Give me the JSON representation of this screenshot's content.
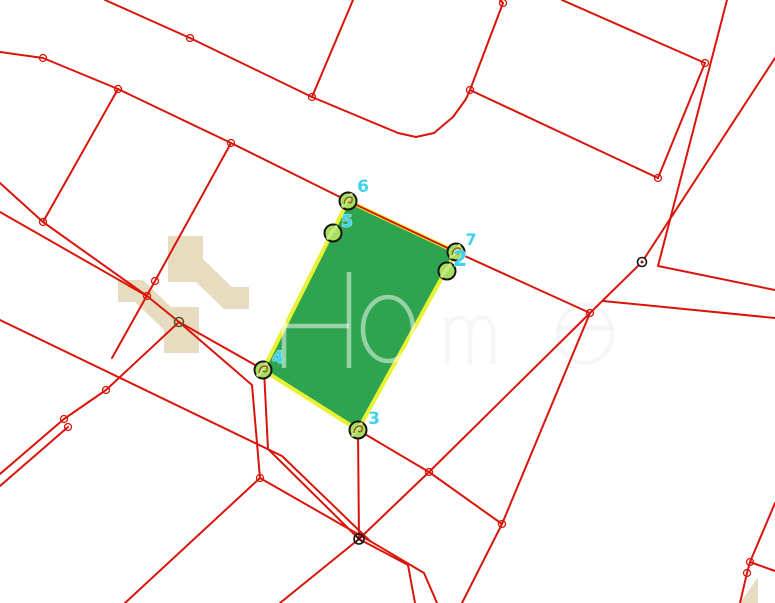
{
  "canvas": {
    "width": 775,
    "height": 603,
    "background": "#ffffff"
  },
  "map": {
    "colors": {
      "line_red": "#d9150b",
      "parcel_fill": "#2fa44e",
      "parcel_stroke": "#e9f232",
      "marker_fill": "#a8e05e",
      "marker_fill_light": "#c3ec86",
      "marker_stroke": "#151515",
      "label_cyan": "#3ed2ee",
      "squiggle_brown": "#96591f",
      "logo_beige": "#e6dabc",
      "watermark_gray": "#cccccc",
      "dark_node": "#55562b",
      "black_node": "#111111"
    },
    "parcel": {
      "points": [
        [
          348,
          201
        ],
        [
          456,
          252
        ],
        [
          358,
          430
        ],
        [
          263,
          370
        ]
      ],
      "stroke_width": 4
    },
    "roads": {
      "stroke_width": 2,
      "polylines": [
        {
          "name": "road-top-diagonal",
          "points": [
            [
              105,
              0
            ],
            [
              190,
              38
            ],
            [
              312,
              97
            ],
            [
              398,
              133
            ],
            [
              416,
              137
            ],
            [
              434,
              133
            ],
            [
              453,
              117
            ],
            [
              466,
              99
            ],
            [
              470,
              90
            ]
          ]
        },
        {
          "name": "parcel-edge-ne",
          "points": [
            [
              500,
              0
            ],
            [
              503,
              3
            ],
            [
              470,
              90
            ]
          ]
        },
        {
          "name": "parcel-edge-east",
          "points": [
            [
              470,
              90
            ],
            [
              658,
              178
            ]
          ]
        },
        {
          "name": "parcel-edge-up",
          "points": [
            [
              658,
              178
            ],
            [
              705,
              63
            ]
          ]
        },
        {
          "name": "parcel-edge-top",
          "points": [
            [
              705,
              63
            ],
            [
              562,
              0
            ]
          ]
        },
        {
          "name": "spur-top-vertical",
          "points": [
            [
              353,
              0
            ],
            [
              312,
              97
            ]
          ]
        },
        {
          "name": "road-main-diagonal",
          "points": [
            [
              0,
              52
            ],
            [
              43,
              58
            ],
            [
              118,
              89
            ],
            [
              231,
              143
            ],
            [
              348,
              201
            ],
            [
              456,
              252
            ],
            [
              590,
              313
            ]
          ]
        },
        {
          "name": "branch-left-vertical",
          "points": [
            [
              118,
              89
            ],
            [
              43,
              222
            ]
          ]
        },
        {
          "name": "branch-center-vertical",
          "points": [
            [
              231,
              143
            ],
            [
              155,
              281
            ],
            [
              112,
              358
            ]
          ]
        },
        {
          "name": "road-left-upper-1",
          "points": [
            [
              0,
              183
            ],
            [
              43,
              222
            ],
            [
              147,
              296
            ],
            [
              179,
              322
            ]
          ]
        },
        {
          "name": "road-left-upper-2",
          "points": [
            [
              0,
              212
            ],
            [
              147,
              296
            ]
          ]
        },
        {
          "name": "road-left-lower-1",
          "points": [
            [
              0,
              320
            ],
            [
              282,
              456
            ],
            [
              370,
              541
            ],
            [
              424,
              573
            ],
            [
              437,
              603
            ]
          ]
        },
        {
          "name": "road-left-lower-2",
          "points": [
            [
              0,
              474
            ],
            [
              64,
              419
            ],
            [
              106,
              390
            ],
            [
              179,
              322
            ]
          ]
        },
        {
          "name": "road-left-lower-3",
          "points": [
            [
              0,
              486
            ],
            [
              68,
              427
            ]
          ]
        },
        {
          "name": "road-v4-south",
          "points": [
            [
              179,
              322
            ],
            [
              264,
              370
            ],
            [
              268,
              449
            ],
            [
              359,
              539
            ],
            [
              408,
              565
            ],
            [
              415,
              603
            ]
          ]
        },
        {
          "name": "road-fan-south",
          "points": [
            [
              179,
              322
            ],
            [
              252,
              385
            ],
            [
              260,
              478
            ],
            [
              125,
              603
            ]
          ]
        },
        {
          "name": "road-fan-southeast",
          "points": [
            [
              260,
              478
            ],
            [
              370,
              541
            ]
          ]
        },
        {
          "name": "road-x-diagonal",
          "points": [
            [
              590,
              313
            ],
            [
              429,
              472
            ],
            [
              359,
              539
            ],
            [
              280,
              603
            ]
          ]
        },
        {
          "name": "road-tri-south",
          "points": [
            [
              590,
              313
            ],
            [
              502,
              524
            ],
            [
              462,
              603
            ]
          ]
        },
        {
          "name": "road-tri-base",
          "points": [
            [
              429,
              472
            ],
            [
              502,
              524
            ]
          ]
        },
        {
          "name": "road-v3-vertical",
          "points": [
            [
              358,
              432
            ],
            [
              359,
              539
            ]
          ]
        },
        {
          "name": "road-v3-link",
          "points": [
            [
              358,
              430
            ],
            [
              429,
              472
            ]
          ]
        },
        {
          "name": "road-ne-outer",
          "points": [
            [
              727,
              0
            ],
            [
              658,
              266
            ],
            [
              775,
              290
            ]
          ]
        },
        {
          "name": "road-ne-inner",
          "points": [
            [
              775,
              58
            ],
            [
              642,
              262
            ],
            [
              590,
              313
            ]
          ]
        },
        {
          "name": "road-east",
          "points": [
            [
              603,
              301
            ],
            [
              775,
              318
            ]
          ]
        },
        {
          "name": "road-se-corner",
          "points": [
            [
              775,
              503
            ],
            [
              750,
              562
            ],
            [
              747,
              573
            ],
            [
              740,
              603
            ]
          ]
        },
        {
          "name": "road-se-spur",
          "points": [
            [
              750,
              562
            ],
            [
              775,
              571
            ]
          ]
        }
      ]
    },
    "nodes": {
      "radius": 3.5,
      "points": [
        [
          43,
          58
        ],
        [
          118,
          89
        ],
        [
          231,
          143
        ],
        [
          190,
          38
        ],
        [
          312,
          97
        ],
        [
          503,
          3
        ],
        [
          470,
          90
        ],
        [
          658,
          178
        ],
        [
          705,
          63
        ],
        [
          43,
          222
        ],
        [
          147,
          296
        ],
        [
          155,
          281
        ],
        [
          106,
          390
        ],
        [
          64,
          419
        ],
        [
          68,
          427
        ],
        [
          260,
          478
        ],
        [
          429,
          472
        ],
        [
          502,
          524
        ],
        [
          590,
          313
        ],
        [
          750,
          562
        ],
        [
          747,
          573
        ]
      ]
    },
    "special_nodes": {
      "dark_ring": {
        "x": 179,
        "y": 322
      },
      "control_point": {
        "x": 642,
        "y": 262
      },
      "x_node": {
        "x": 359,
        "y": 539
      }
    },
    "markers": {
      "radius": 8.5,
      "items": [
        {
          "id": "6",
          "cx": 348,
          "cy": 201,
          "label": "6",
          "lx": 363,
          "ly": 192,
          "size": 17,
          "squiggle": true
        },
        {
          "id": "5",
          "cx": 333,
          "cy": 233,
          "label": "5",
          "lx": 347,
          "ly": 227,
          "size": 17,
          "squiggle": false
        },
        {
          "id": "7",
          "cx": 456,
          "cy": 252,
          "label": "7",
          "lx": 471,
          "ly": 245,
          "size": 16,
          "squiggle": true
        },
        {
          "id": "2",
          "cx": 447,
          "cy": 271,
          "label": "2",
          "lx": 460,
          "ly": 266,
          "size": 21,
          "squiggle": false
        },
        {
          "id": "4",
          "cx": 263,
          "cy": 370,
          "label": "4",
          "lx": 278,
          "ly": 363,
          "size": 17,
          "squiggle": true
        },
        {
          "id": "3",
          "cx": 358,
          "cy": 430,
          "label": "3",
          "lx": 374,
          "ly": 424,
          "size": 17,
          "squiggle": true
        }
      ]
    },
    "watermark": {
      "logo_pieces": [
        {
          "name": "logo-arrow-upper",
          "d": "M168,236 L203,236 L203,259 L232,287 L249,287 L249,309 L224,309 L196,282 L168,282 Z"
        },
        {
          "name": "logo-arrow-lower",
          "d": "M199,353 L164,353 L164,330 L135,302 L118,302 L118,280 L143,280 L171,307 L199,307 Z"
        },
        {
          "name": "logo-corner-triangle",
          "d": "M740,603 L758,577 L758,603 Z"
        }
      ],
      "text_hint": "Ho",
      "letters": {
        "stroke_width": 4.5,
        "strong_opacity": 0.5,
        "faint_opacity": 0.18,
        "H": {
          "x1": 284,
          "x2": 349,
          "y_top": 272,
          "y_bottom": 368,
          "bar_y": 326
        },
        "o": {
          "cx": 388,
          "cy": 329,
          "rx": 25,
          "ry": 32
        },
        "m": {
          "d": "M447,364 L447,318 M447,333 C447,314 470,311 470,331 L470,364 M470,333 C470,314 493,311 493,331 L493,364"
        },
        "e": {
          "cx": 585,
          "cy": 334,
          "rx": 27,
          "ry": 29,
          "bar_y": 328
        }
      }
    }
  }
}
